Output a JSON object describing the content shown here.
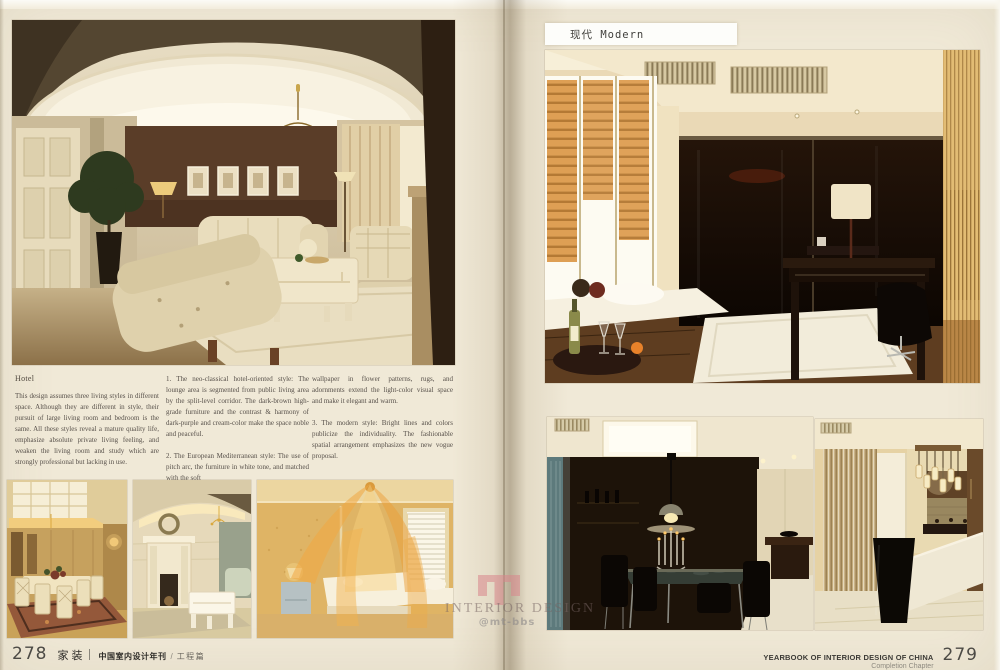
{
  "colors": {
    "page_bg": "#f0e9d7",
    "ink": "#57504a",
    "watermark_pink": "#d9868c",
    "label_bg": "#fdfdfa"
  },
  "left_page": {
    "page_number": "278",
    "article": {
      "heading": "Hotel",
      "intro": "This design assumes three living styles in different space. Although they are different in style, their pursuit of large living room and bedroom is the same. All these styles reveal a mature quality life, emphasize absolute private living feeling, and weaken the living room and study which are strongly professional but lacking in use.",
      "style1": "1. The neo-classical hotel-oriented style: The lounge area is segmented from public living area by the split-level corridor. The dark-brown high-grade furniture and the contrast & harmony of dark-purple and cream-color make the space noble and peaceful.",
      "style2": "2. The European Mediterranean style: The use of pitch arc, the furniture in white tone, and matched with the soft",
      "style2_cont": "wallpaper in flower patterns, rugs, and adornments extend the light-color visual space and make it elegant and warm.",
      "style3": "3. The modern style: Bright lines and colors publicize the individuality. The fashionable spatial arrangement emphasizes the new vogue proposal."
    },
    "footer": {
      "brand": "家装",
      "journal": "中国室内设计年刊",
      "separator": "/",
      "section": "工程篇"
    }
  },
  "right_page": {
    "page_number": "279",
    "section_label": "现代 Modern",
    "footer": {
      "title": "YEARBOOK OF INTERIOR DESIGN OF CHINA",
      "subtitle": "Completion Chapter"
    }
  },
  "watermark": {
    "title": "INTERIOR DESIGN",
    "handle": "@mt-bbs"
  }
}
